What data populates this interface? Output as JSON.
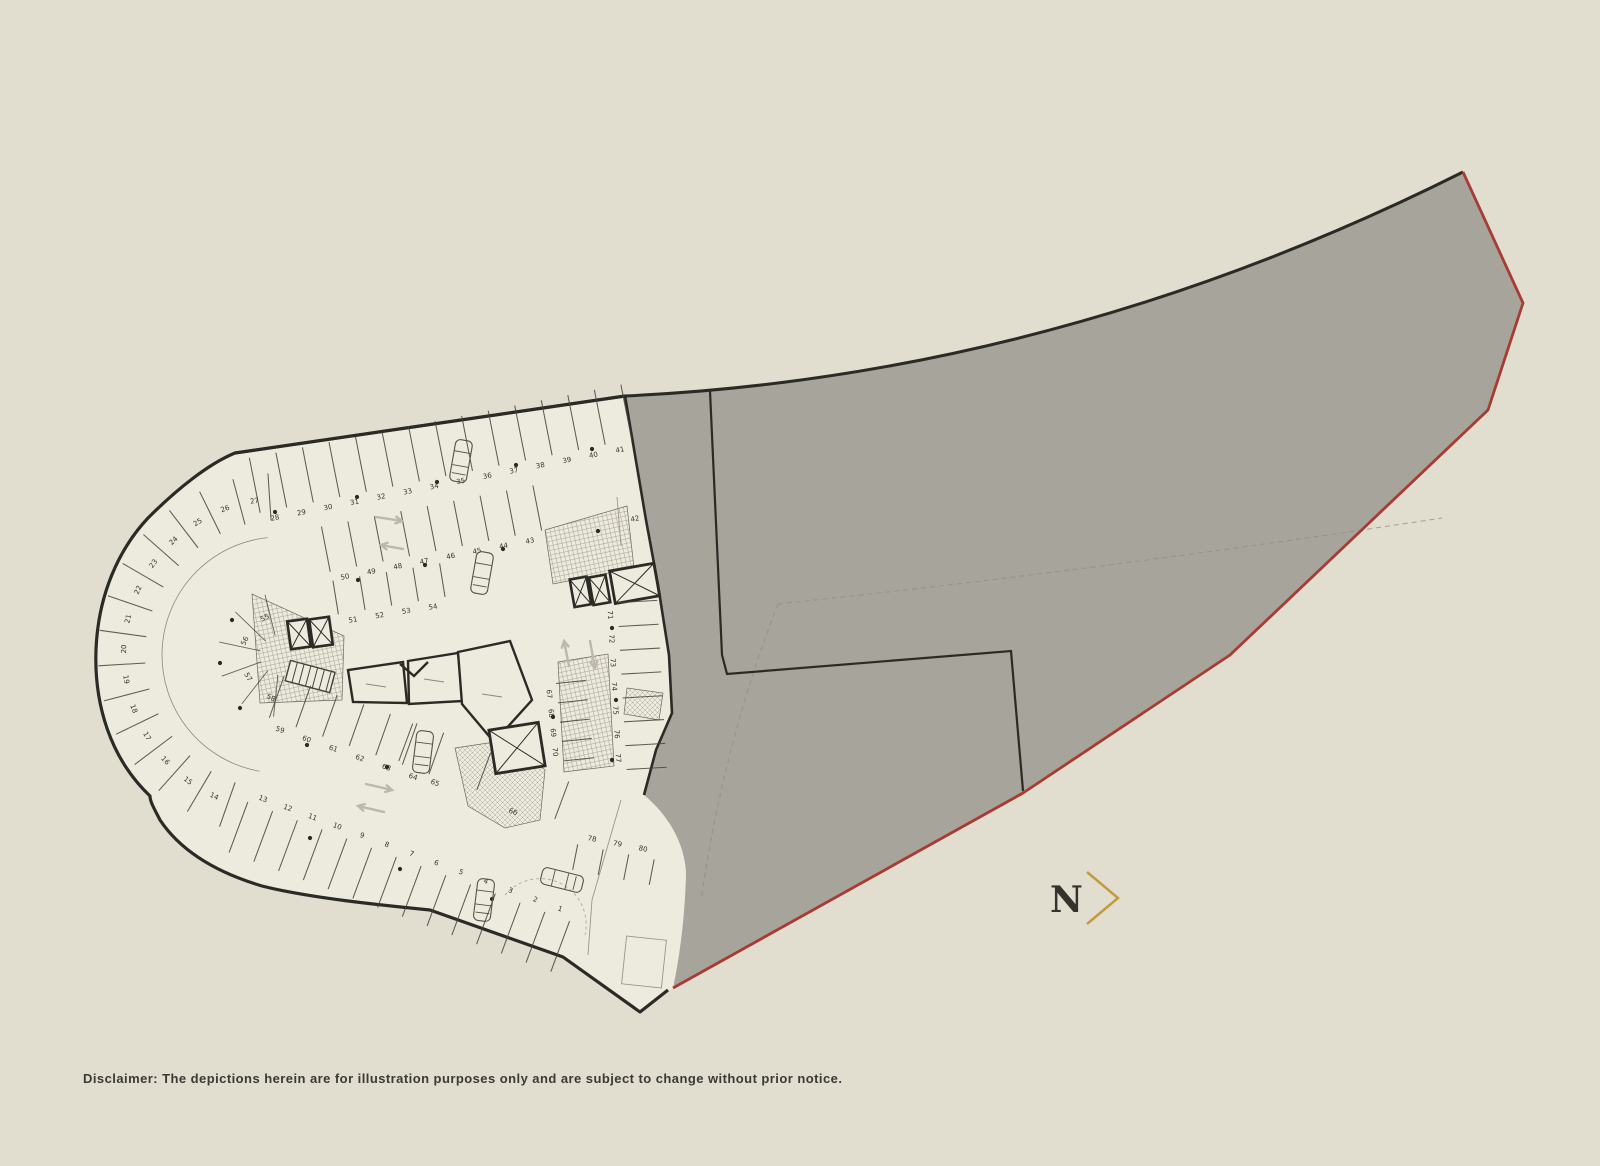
{
  "page": {
    "background": "#e1ded0"
  },
  "colors": {
    "site_fill": "#a7a49c",
    "plan_fill": "#edebde",
    "boundary_black": "#2b2a25",
    "boundary_red": "#a63c33",
    "plan_line": "#45443c",
    "faint_line": "#9a968a",
    "arrow": "#bcb8aa",
    "gold": "#c49a3e",
    "text_dark": "#3a3934"
  },
  "compass": {
    "label": "N"
  },
  "disclaimer": "Disclaimer: The depictions herein are for illustration purposes only and are subject to change without prior notice.",
  "parking": {
    "rows": [
      {
        "name": "stalls-28-41",
        "numbers": [
          "28",
          "29",
          "30",
          "31",
          "32",
          "33",
          "34",
          "35",
          "36",
          "37",
          "38",
          "39",
          "40",
          "41"
        ],
        "x1": 275,
        "y1": 518,
        "x2": 620,
        "y2": 450,
        "side": 1,
        "len": 56
      },
      {
        "name": "stalls-43-50",
        "numbers": [
          "50",
          "49",
          "48",
          "47",
          "46",
          "45",
          "44",
          "43"
        ],
        "x1": 345,
        "y1": 577,
        "x2": 530,
        "y2": 541,
        "side": 1,
        "len": 46
      },
      {
        "name": "stalls-51-54",
        "numbers": [
          "51",
          "52",
          "53",
          "54"
        ],
        "x1": 353,
        "y1": 620,
        "x2": 433,
        "y2": 607,
        "side": 1,
        "len": 34
      },
      {
        "name": "stalls-59-64",
        "numbers": [
          "59",
          "60",
          "61",
          "62",
          "63",
          "64"
        ],
        "x1": 280,
        "y1": 730,
        "x2": 413,
        "y2": 777,
        "side": 1,
        "len": 44
      },
      {
        "name": "stalls-65-66",
        "numbers": [
          "65",
          "66"
        ],
        "x1": 435,
        "y1": 783,
        "x2": 513,
        "y2": 812,
        "side": 1,
        "len": 40
      },
      {
        "name": "stalls-67-70",
        "numbers": [
          "67",
          "68",
          "69",
          "70"
        ],
        "x1": 549,
        "y1": 694,
        "x2": 555,
        "y2": 752,
        "side": 1,
        "len": 30
      },
      {
        "name": "stalls-71-77",
        "numbers": [
          "71",
          "72",
          "73",
          "74",
          "75",
          "76",
          "77"
        ],
        "x1": 610,
        "y1": 615,
        "x2": 618,
        "y2": 758,
        "side": 1,
        "len": 40
      },
      {
        "name": "stalls-78-80",
        "numbers": [
          "78",
          "79",
          "80"
        ],
        "x1": 592,
        "y1": 839,
        "x2": 643,
        "y2": 849,
        "side": -1,
        "len": 26
      },
      {
        "name": "stalls-1-13",
        "numbers": [
          "1",
          "2",
          "3",
          "4",
          "5",
          "6",
          "7",
          "8",
          "9",
          "10",
          "11",
          "12",
          "13"
        ],
        "x1": 560,
        "y1": 909,
        "x2": 263,
        "y2": 799,
        "side": 1,
        "len": 54
      },
      {
        "name": "stall-42",
        "numbers": [
          "42"
        ],
        "x1": 635,
        "y1": 519,
        "x2": 645,
        "y2": 517,
        "side": 1,
        "len": 0
      }
    ],
    "radial": {
      "name": "stalls-14-27",
      "numbers": [
        "14",
        "15",
        "16",
        "17",
        "18",
        "19",
        "20",
        "21",
        "22",
        "23",
        "24",
        "25",
        "26",
        "27"
      ],
      "cx": 280,
      "cy": 655,
      "label_r": 156,
      "angle_start": 115,
      "angle_step": 11.2,
      "tick_r1": 135,
      "tick_r2": 182
    },
    "hub_stalls": {
      "numbers": [
        "55",
        "56",
        "57",
        "58"
      ],
      "positions": [
        [
          265,
          618,
          -25
        ],
        [
          245,
          641,
          -65
        ],
        [
          248,
          677,
          60
        ],
        [
          271,
          698,
          25
        ]
      ]
    },
    "cars": [
      [
        461,
        461,
        100
      ],
      [
        482,
        573,
        100
      ],
      [
        423,
        752,
        97
      ],
      [
        562,
        880,
        14
      ],
      [
        484,
        900,
        97
      ]
    ],
    "arrows": [
      [
        376,
        517,
        402,
        521
      ],
      [
        403,
        549,
        381,
        545
      ],
      [
        569,
        666,
        564,
        641
      ],
      [
        590,
        641,
        595,
        668
      ],
      [
        366,
        784,
        392,
        790
      ],
      [
        384,
        812,
        358,
        806
      ]
    ],
    "dots": [
      [
        275,
        512
      ],
      [
        357,
        497
      ],
      [
        437,
        482
      ],
      [
        516,
        465
      ],
      [
        592,
        449
      ],
      [
        358,
        580
      ],
      [
        425,
        565
      ],
      [
        503,
        549
      ],
      [
        232,
        620
      ],
      [
        220,
        663
      ],
      [
        240,
        708
      ],
      [
        307,
        745
      ],
      [
        387,
        767
      ],
      [
        310,
        838
      ],
      [
        400,
        869
      ],
      [
        492,
        899
      ],
      [
        612,
        628
      ],
      [
        616,
        700
      ],
      [
        612,
        760
      ],
      [
        598,
        531
      ],
      [
        553,
        717
      ]
    ]
  }
}
